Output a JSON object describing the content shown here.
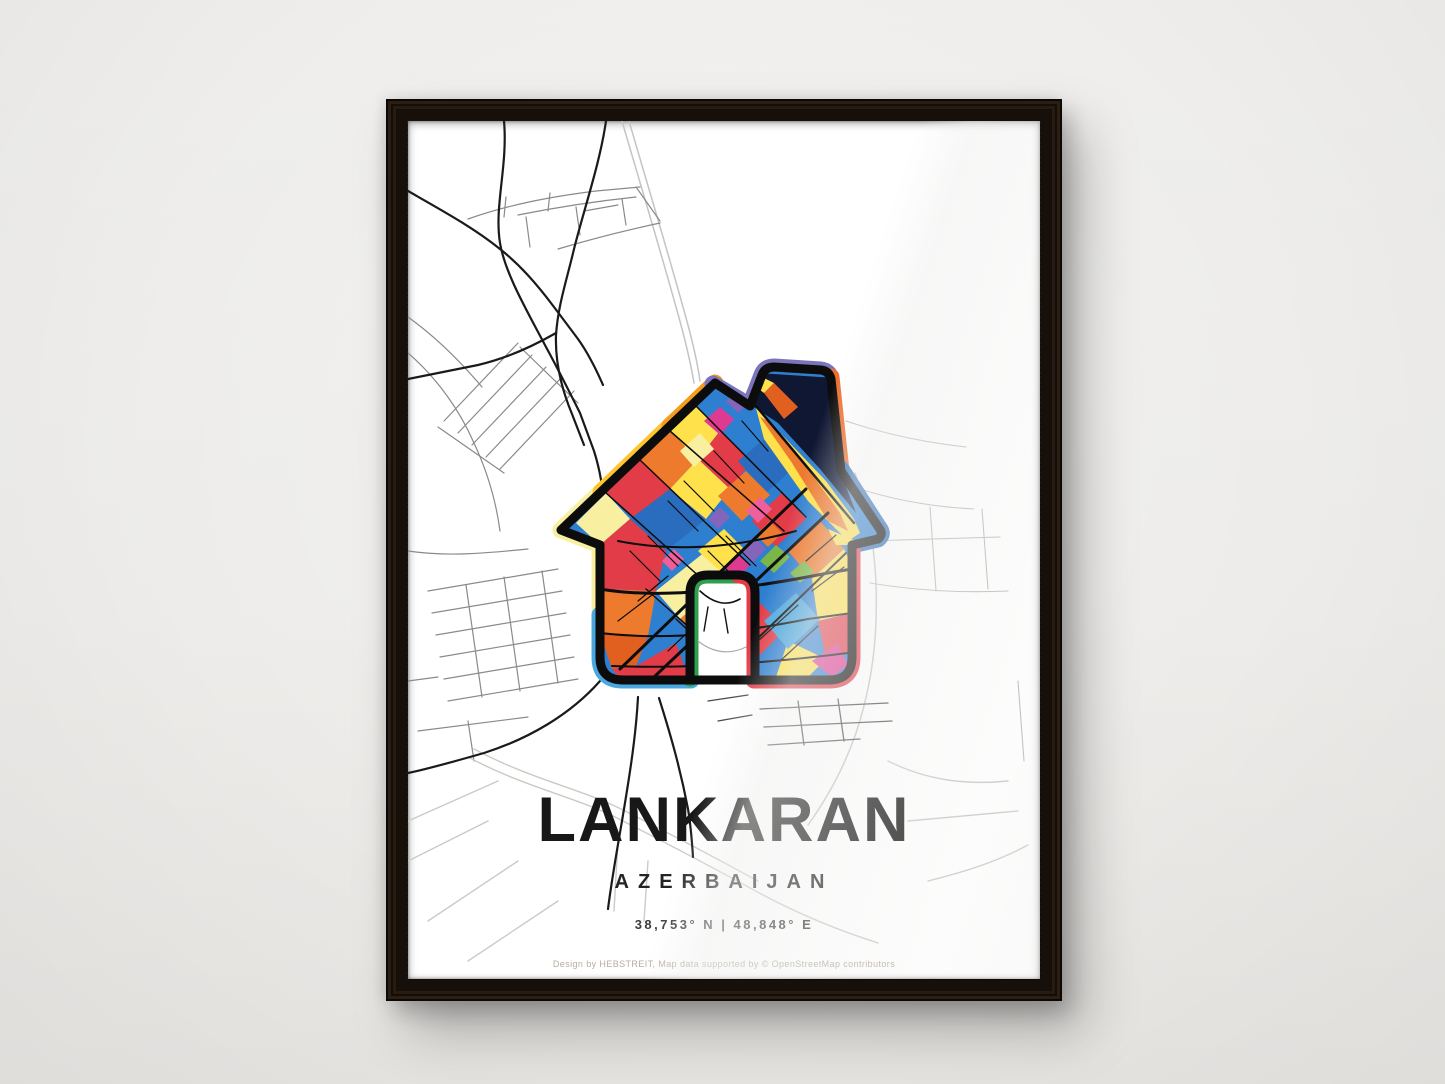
{
  "scene": {
    "wall_color": "#edecea",
    "frame_color": "#1c130c"
  },
  "poster": {
    "title": "LANKARAN",
    "country": "AZERBAIJAN",
    "coordinates": "38,753° N | 48,848° E",
    "attribution": "Design by HEBSTREIT, Map data supported by © OpenStreetMap contributors",
    "icon": {
      "name": "house-map-icon",
      "palette": {
        "pale_yellow": "#f8efa0",
        "gold": "#fdc62f",
        "amber": "#f49d1d",
        "purple": "#7b74bd",
        "orange": "#ee6d2d",
        "orange_deep": "#e2601f",
        "blue": "#2e7fd0",
        "blue_dark": "#2a6cbd",
        "ring_blue": "#2f6db8",
        "light_blue": "#4aa7e0",
        "red": "#e23c48",
        "green": "#2f9e4d",
        "leaf_green": "#7ab648",
        "magenta": "#df3a92",
        "pink": "#ee5f9b",
        "violet": "#8565bb",
        "yellow": "#ffe14b",
        "navy": "#101732"
      },
      "map_road_colors": {
        "main_road": "#1a1a1a",
        "street": "#8a8a8a",
        "highway": "#c4c4c4",
        "faint": "#cdcac5"
      }
    }
  }
}
